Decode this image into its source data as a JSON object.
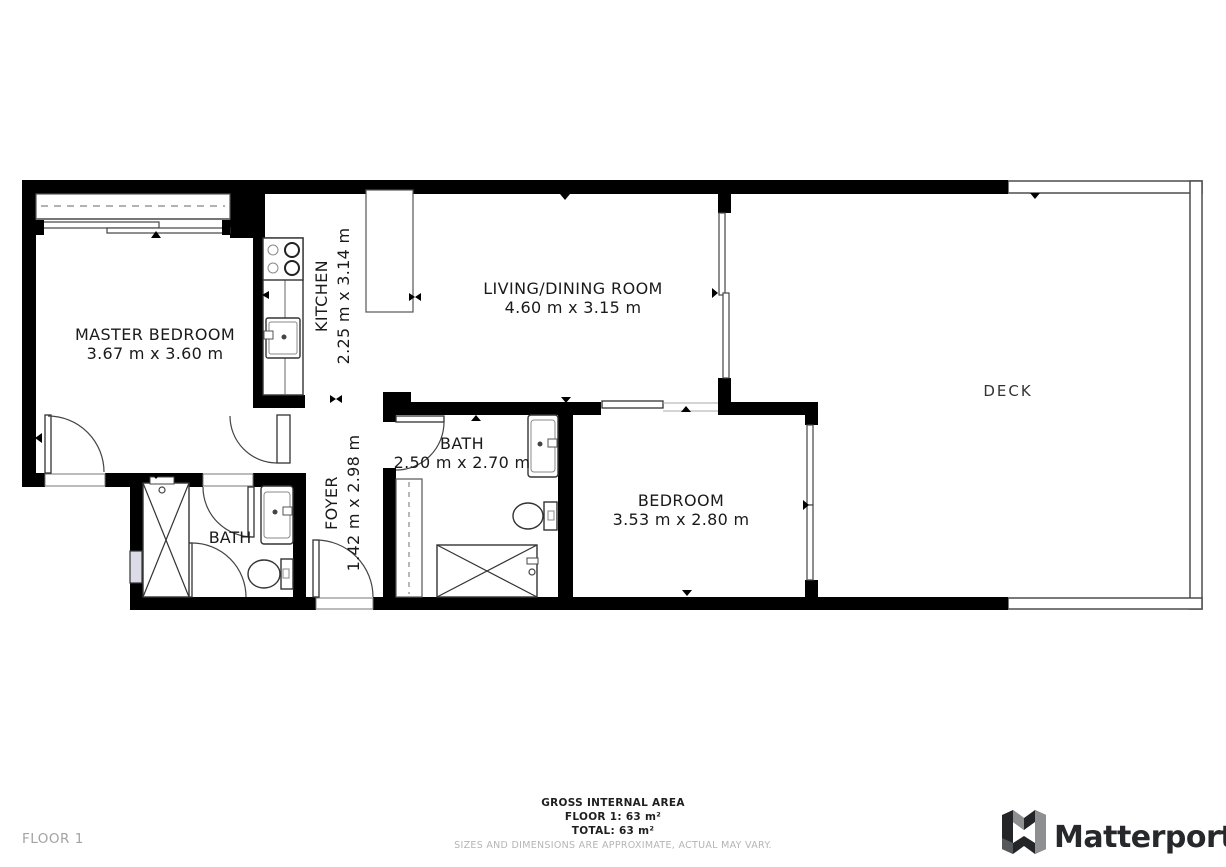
{
  "rooms": {
    "master_bedroom": {
      "name": "MASTER BEDROOM",
      "dims": "3.67 m x 3.60 m"
    },
    "kitchen": {
      "name": "KITCHEN",
      "dims": "2.25 m x 3.14 m"
    },
    "living_dining": {
      "name": "LIVING/DINING ROOM",
      "dims": "4.60 m x 3.15 m"
    },
    "deck": {
      "name": "DECK"
    },
    "bath_main": {
      "name": "BATH",
      "dims": "2.50 m x 2.70 m"
    },
    "bedroom": {
      "name": "BEDROOM",
      "dims": "3.53 m x 2.80 m"
    },
    "foyer": {
      "name": "FOYER",
      "dims": "1.42 m x 2.98 m"
    },
    "bath_ensuite": {
      "name": "BATH"
    }
  },
  "footer": {
    "area_title": "GROSS INTERNAL AREA",
    "floor_area": "FLOOR 1: 63 m²",
    "total_area": "TOTAL: 63 m²",
    "disclaimer": "SIZES AND DIMENSIONS ARE APPROXIMATE, ACTUAL MAY VARY."
  },
  "floor_label": "FLOOR 1",
  "branding": {
    "logo_text": "Matterport"
  },
  "colors": {
    "wall": "#000000",
    "background": "#ffffff",
    "muted_text": "#b5b5b5",
    "floor_label_text": "#a3a3a3",
    "logo_text": "#26282b",
    "window_fill": "#dcdce8"
  }
}
